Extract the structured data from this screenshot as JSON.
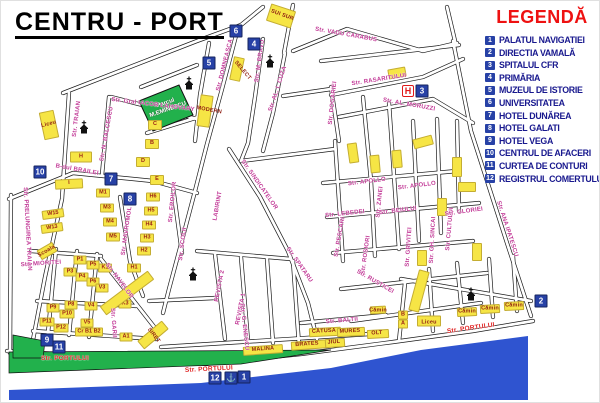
{
  "title": "CENTRU - PORT",
  "legend": {
    "title": "LEGENDĂ",
    "items": [
      {
        "num": "1",
        "label": "PALATUL NAVIGATIEI"
      },
      {
        "num": "2",
        "label": "DIRECTIA VAMALĂ"
      },
      {
        "num": "3",
        "label": "SPITALUL CFR"
      },
      {
        "num": "4",
        "label": "PRIMĂRIA"
      },
      {
        "num": "5",
        "label": "MUZEUL DE ISTORIE"
      },
      {
        "num": "6",
        "label": "UNIVERSITATEA"
      },
      {
        "num": "7",
        "label": "HOTEL DUNĂREA"
      },
      {
        "num": "8",
        "label": "HOTEL GALATI"
      },
      {
        "num": "9",
        "label": "HOTEL VEGA"
      },
      {
        "num": "10",
        "label": "CENTRUL DE AFACERI"
      },
      {
        "num": "11",
        "label": "CURTEA DE CONTURI"
      },
      {
        "num": "12",
        "label": "REGISTRUL COMERTULUI"
      }
    ]
  },
  "park": {
    "line1": "Parcul",
    "line2": "M.EMINESCU"
  },
  "colors": {
    "legend_red": "#ee1111",
    "legend_text_blue": "#18188e",
    "marker_blue": "#2741a6",
    "street_label_pink": "#c23a97",
    "portului_red": "#e02525",
    "building_yellow": "#f6e545",
    "building_text_red": "#8f1d12",
    "park_green": "#22b14c",
    "water_blue": "#2f54d0",
    "hospital_red": "#e01818"
  },
  "markers": [
    {
      "n": "1",
      "x": 243,
      "y": 376
    },
    {
      "n": "2",
      "x": 540,
      "y": 300
    },
    {
      "n": "3",
      "x": 421,
      "y": 90
    },
    {
      "n": "4",
      "x": 253,
      "y": 43
    },
    {
      "n": "5",
      "x": 208,
      "y": 62
    },
    {
      "n": "6",
      "x": 235,
      "y": 30
    },
    {
      "n": "7",
      "x": 110,
      "y": 178
    },
    {
      "n": "8",
      "x": 129,
      "y": 198
    },
    {
      "n": "9",
      "x": 46,
      "y": 339
    },
    {
      "n": "10",
      "x": 39,
      "y": 171
    },
    {
      "n": "11",
      "x": 58,
      "y": 346
    },
    {
      "n": "12",
      "x": 214,
      "y": 377
    }
  ],
  "hospital_marker": {
    "label": "H",
    "x": 407,
    "y": 90
  },
  "anchor_marker": {
    "icon": "anchor-icon",
    "glyph": "⚓",
    "x": 230,
    "y": 377
  },
  "churches": [
    {
      "icon": "church-icon",
      "x": 188,
      "y": 82
    },
    {
      "icon": "church-icon",
      "x": 269,
      "y": 60
    },
    {
      "icon": "church-icon",
      "x": 83,
      "y": 126
    },
    {
      "icon": "church-icon",
      "x": 192,
      "y": 273
    },
    {
      "icon": "church-icon",
      "x": 470,
      "y": 293
    }
  ],
  "street_labels": [
    {
      "t": "Str. TRAIAN",
      "x": 76,
      "y": 118,
      "r": -83
    },
    {
      "t": "Str. N. BALCESCU",
      "x": 106,
      "y": 133,
      "r": -80
    },
    {
      "t": "Str. Gral IACOB LAHOVARY",
      "x": 152,
      "y": 104,
      "r": 7
    },
    {
      "t": "Str. DOMNEASCA",
      "x": 224,
      "y": 64,
      "r": -76
    },
    {
      "t": "Str. M. BRAVU",
      "x": 259,
      "y": 60,
      "r": -82
    },
    {
      "t": "Str. AL. I. CUZA",
      "x": 277,
      "y": 88,
      "r": -72
    },
    {
      "t": "Str. VADU CARABUS",
      "x": 345,
      "y": 34,
      "r": 10
    },
    {
      "t": "Str. RASARITULUI",
      "x": 378,
      "y": 79,
      "r": -9
    },
    {
      "t": "Str. AL. MORUZZI",
      "x": 408,
      "y": 104,
      "r": 10
    },
    {
      "t": "Str. DOGARIEI",
      "x": 332,
      "y": 102,
      "r": -84
    },
    {
      "t": "B-dul BRAILEI",
      "x": 76,
      "y": 169,
      "r": 10
    },
    {
      "t": "Str. EROILOR",
      "x": 172,
      "y": 201,
      "r": -84
    },
    {
      "t": "Str. SINDICATELOR",
      "x": 258,
      "y": 184,
      "r": 55
    },
    {
      "t": "LABIRINT",
      "x": 217,
      "y": 205,
      "r": -80
    },
    {
      "t": "Str. MAVROMOL",
      "x": 126,
      "y": 230,
      "r": -82
    },
    {
      "t": "Str. APOLLO",
      "x": 366,
      "y": 181,
      "r": -7
    },
    {
      "t": "Str. APOLLO",
      "x": 416,
      "y": 185,
      "r": -7
    },
    {
      "t": "Str. ZANEI",
      "x": 379,
      "y": 201,
      "r": -84
    },
    {
      "t": "Str. LEBEDEI",
      "x": 344,
      "y": 213,
      "r": -6
    },
    {
      "t": "Str. BEIULUI",
      "x": 397,
      "y": 210,
      "r": -7
    },
    {
      "t": "Str. PESCARI",
      "x": 339,
      "y": 236,
      "r": -80
    },
    {
      "t": "Str. ROSIORI",
      "x": 365,
      "y": 254,
      "r": -82
    },
    {
      "t": "Str. GRIVITEI",
      "x": 408,
      "y": 246,
      "r": -86
    },
    {
      "t": "Str. GH. SINCAI",
      "x": 432,
      "y": 239,
      "r": -87
    },
    {
      "t": "Str. CULTULUI",
      "x": 449,
      "y": 228,
      "r": -85
    },
    {
      "t": "Str. GLORIEI",
      "x": 463,
      "y": 211,
      "r": -8
    },
    {
      "t": "Str. ANA IPATESCU",
      "x": 506,
      "y": 228,
      "r": 72
    },
    {
      "t": "Str. PRELUNGIREA TRAIAN",
      "x": 26,
      "y": 228,
      "r": 87
    },
    {
      "t": "Str. NAVELOR",
      "x": 118,
      "y": 280,
      "r": 53
    },
    {
      "t": "Str. SCOLII",
      "x": 182,
      "y": 243,
      "r": -83
    },
    {
      "t": "Str. MIORITEI",
      "x": 40,
      "y": 263,
      "r": -4
    },
    {
      "t": "Str. GARII",
      "x": 112,
      "y": 322,
      "r": 86
    },
    {
      "t": "Str. G. ENESCU",
      "x": 243,
      "y": 326,
      "r": 84
    },
    {
      "t": "REVISTA 2",
      "x": 219,
      "y": 285,
      "r": -79
    },
    {
      "t": "REVISTA 1",
      "x": 240,
      "y": 308,
      "r": -79
    },
    {
      "t": "Str. SPATARU",
      "x": 298,
      "y": 264,
      "r": 55
    },
    {
      "t": "Str. BALTII",
      "x": 341,
      "y": 320,
      "r": -5
    },
    {
      "t": "Str. RUSTICEI",
      "x": 374,
      "y": 281,
      "r": 30
    },
    {
      "t": "Str. PORTULUI",
      "x": 64,
      "y": 358,
      "r": 0,
      "v": "r"
    },
    {
      "t": "Str. PORTULUI",
      "x": 208,
      "y": 369,
      "r": -3,
      "v": "r"
    },
    {
      "t": "Str. PORTULUI",
      "x": 470,
      "y": 328,
      "r": -8,
      "v": "r"
    },
    {
      "t": "Liceu",
      "x": 48,
      "y": 124,
      "r": -15,
      "v": "b"
    },
    {
      "t": "SELECT",
      "x": 241,
      "y": 70,
      "r": 50,
      "v": "b"
    },
    {
      "t": "MODERN",
      "x": 208,
      "y": 110,
      "r": 10,
      "v": "b"
    },
    {
      "t": "SUI SUR",
      "x": 281,
      "y": 15,
      "r": 20,
      "v": "b"
    },
    {
      "t": "Scoala",
      "x": 46,
      "y": 251,
      "r": -30,
      "v": "b"
    },
    {
      "t": "SIRET",
      "x": 152,
      "y": 335,
      "r": 52,
      "v": "b"
    },
    {
      "t": "MALINA",
      "x": 262,
      "y": 349,
      "r": -4,
      "v": "b"
    },
    {
      "t": "BRATES",
      "x": 306,
      "y": 344,
      "r": -4,
      "v": "b"
    },
    {
      "t": "JIUL",
      "x": 333,
      "y": 342,
      "r": -4,
      "v": "b"
    },
    {
      "t": "CĂTUSA",
      "x": 323,
      "y": 331,
      "r": -3,
      "v": "b"
    },
    {
      "t": "MURES",
      "x": 349,
      "y": 331,
      "r": -3,
      "v": "b"
    },
    {
      "t": "OLT",
      "x": 376,
      "y": 333,
      "r": -3,
      "v": "b"
    },
    {
      "t": "Liceu",
      "x": 428,
      "y": 322,
      "r": 0,
      "v": "b"
    },
    {
      "t": "Cămin",
      "x": 466,
      "y": 311,
      "r": 0,
      "v": "b"
    },
    {
      "t": "Cămin",
      "x": 489,
      "y": 308,
      "r": 0,
      "v": "b"
    },
    {
      "t": "Cămin",
      "x": 513,
      "y": 305,
      "r": 0,
      "v": "b"
    },
    {
      "t": "Cămin",
      "x": 377,
      "y": 310,
      "r": 0,
      "v": "b"
    }
  ],
  "buildings": [
    {
      "l": "",
      "x": 48,
      "y": 124,
      "w": 13,
      "h": 26,
      "r": -12
    },
    {
      "l": "H",
      "x": 80,
      "y": 156,
      "w": 20,
      "h": 9,
      "r": 0
    },
    {
      "l": "I",
      "x": 68,
      "y": 183,
      "w": 26,
      "h": 8,
      "r": -3
    },
    {
      "l": "C",
      "x": 154,
      "y": 124,
      "w": 12,
      "h": 8,
      "r": 0
    },
    {
      "l": "B",
      "x": 151,
      "y": 143,
      "w": 12,
      "h": 8,
      "r": 0
    },
    {
      "l": "D",
      "x": 142,
      "y": 161,
      "w": 12,
      "h": 8,
      "r": 0
    },
    {
      "l": "E",
      "x": 156,
      "y": 179,
      "w": 12,
      "h": 8,
      "r": 0
    },
    {
      "l": "M1",
      "x": 102,
      "y": 192,
      "w": 12,
      "h": 7,
      "r": 0
    },
    {
      "l": "M3",
      "x": 106,
      "y": 207,
      "w": 12,
      "h": 7,
      "r": 0
    },
    {
      "l": "M4",
      "x": 109,
      "y": 221,
      "w": 12,
      "h": 7,
      "r": 0
    },
    {
      "l": "M5",
      "x": 112,
      "y": 236,
      "w": 12,
      "h": 7,
      "r": 0
    },
    {
      "l": "H6",
      "x": 152,
      "y": 196,
      "w": 12,
      "h": 7,
      "r": 0
    },
    {
      "l": "H5",
      "x": 150,
      "y": 210,
      "w": 12,
      "h": 7,
      "r": 0
    },
    {
      "l": "H4",
      "x": 148,
      "y": 224,
      "w": 12,
      "h": 7,
      "r": 0
    },
    {
      "l": "H3",
      "x": 146,
      "y": 237,
      "w": 12,
      "h": 7,
      "r": 0
    },
    {
      "l": "H2",
      "x": 143,
      "y": 250,
      "w": 12,
      "h": 7,
      "r": 0
    },
    {
      "l": "H1",
      "x": 133,
      "y": 267,
      "w": 12,
      "h": 7,
      "r": 0
    },
    {
      "l": "W15",
      "x": 52,
      "y": 213,
      "w": 20,
      "h": 7,
      "r": -8
    },
    {
      "l": "W13",
      "x": 51,
      "y": 227,
      "w": 20,
      "h": 7,
      "r": -8
    },
    {
      "l": "K1",
      "x": 104,
      "y": 267,
      "w": 12,
      "h": 7,
      "r": 0
    },
    {
      "l": "P1",
      "x": 79,
      "y": 259,
      "w": 11,
      "h": 7,
      "r": 0
    },
    {
      "l": "P5",
      "x": 92,
      "y": 264,
      "w": 11,
      "h": 7,
      "r": 0
    },
    {
      "l": "P3",
      "x": 69,
      "y": 271,
      "w": 11,
      "h": 7,
      "r": 0
    },
    {
      "l": "P4",
      "x": 81,
      "y": 276,
      "w": 11,
      "h": 7,
      "r": 0
    },
    {
      "l": "P6",
      "x": 92,
      "y": 281,
      "w": 11,
      "h": 7,
      "r": 0
    },
    {
      "l": "V3",
      "x": 101,
      "y": 287,
      "w": 11,
      "h": 7,
      "r": 0
    },
    {
      "l": "P9",
      "x": 52,
      "y": 307,
      "w": 11,
      "h": 7,
      "r": 0
    },
    {
      "l": "P8",
      "x": 70,
      "y": 304,
      "w": 11,
      "h": 7,
      "r": 0
    },
    {
      "l": "P10",
      "x": 66,
      "y": 313,
      "w": 13,
      "h": 7,
      "r": 0
    },
    {
      "l": "P11",
      "x": 46,
      "y": 321,
      "w": 13,
      "h": 7,
      "r": 0
    },
    {
      "l": "P12",
      "x": 60,
      "y": 327,
      "w": 13,
      "h": 7,
      "r": 0
    },
    {
      "l": "V4",
      "x": 90,
      "y": 305,
      "w": 11,
      "h": 7,
      "r": 0
    },
    {
      "l": "V5",
      "x": 86,
      "y": 322,
      "w": 11,
      "h": 7,
      "r": 0
    },
    {
      "l": "Cr B1 B2",
      "x": 88,
      "y": 331,
      "w": 26,
      "h": 7,
      "r": 0
    },
    {
      "l": "K3",
      "x": 124,
      "y": 303,
      "w": 11,
      "h": 7,
      "r": 0
    },
    {
      "l": "A1",
      "x": 125,
      "y": 336,
      "w": 11,
      "h": 7,
      "r": 0
    },
    {
      "l": "",
      "x": 236,
      "y": 68,
      "w": 9,
      "h": 22,
      "r": 12
    },
    {
      "l": "",
      "x": 204,
      "y": 110,
      "w": 11,
      "h": 30,
      "r": 8
    },
    {
      "l": "",
      "x": 280,
      "y": 15,
      "w": 24,
      "h": 16,
      "r": 18
    },
    {
      "l": "",
      "x": 46,
      "y": 250,
      "w": 16,
      "h": 9,
      "r": -30
    },
    {
      "l": "B",
      "x": 402,
      "y": 314,
      "w": 8,
      "h": 7,
      "r": 0
    },
    {
      "l": "A",
      "x": 402,
      "y": 323,
      "w": 8,
      "h": 7,
      "r": 0
    },
    {
      "l": "",
      "x": 428,
      "y": 320,
      "w": 22,
      "h": 9,
      "r": 0
    },
    {
      "l": "",
      "x": 466,
      "y": 311,
      "w": 18,
      "h": 7,
      "r": -3
    },
    {
      "l": "",
      "x": 489,
      "y": 308,
      "w": 18,
      "h": 7,
      "r": -3
    },
    {
      "l": "",
      "x": 513,
      "y": 305,
      "w": 18,
      "h": 7,
      "r": -3
    },
    {
      "l": "",
      "x": 377,
      "y": 309,
      "w": 14,
      "h": 6,
      "r": -3
    },
    {
      "l": "",
      "x": 126,
      "y": 292,
      "w": 9,
      "h": 58,
      "r": 53
    },
    {
      "l": "",
      "x": 152,
      "y": 334,
      "w": 9,
      "h": 30,
      "r": 50
    },
    {
      "l": "",
      "x": 418,
      "y": 290,
      "w": 9,
      "h": 40,
      "r": 15
    },
    {
      "l": "",
      "x": 262,
      "y": 349,
      "w": 38,
      "h": 7,
      "r": -4
    },
    {
      "l": "",
      "x": 308,
      "y": 344,
      "w": 34,
      "h": 7,
      "r": -4
    },
    {
      "l": "",
      "x": 334,
      "y": 342,
      "w": 18,
      "h": 7,
      "r": -4
    },
    {
      "l": "",
      "x": 324,
      "y": 331,
      "w": 30,
      "h": 7,
      "r": -3
    },
    {
      "l": "",
      "x": 350,
      "y": 331,
      "w": 26,
      "h": 7,
      "r": -3
    },
    {
      "l": "",
      "x": 377,
      "y": 333,
      "w": 20,
      "h": 7,
      "r": -3
    },
    {
      "l": "",
      "x": 352,
      "y": 152,
      "w": 8,
      "h": 18,
      "r": -8
    },
    {
      "l": "",
      "x": 374,
      "y": 163,
      "w": 8,
      "h": 16,
      "r": -5
    },
    {
      "l": "",
      "x": 396,
      "y": 158,
      "w": 8,
      "h": 16,
      "r": -5
    },
    {
      "l": "",
      "x": 422,
      "y": 141,
      "w": 18,
      "h": 8,
      "r": -15
    },
    {
      "l": "",
      "x": 456,
      "y": 166,
      "w": 8,
      "h": 18,
      "r": 0
    },
    {
      "l": "",
      "x": 466,
      "y": 186,
      "w": 16,
      "h": 8,
      "r": 0
    },
    {
      "l": "",
      "x": 441,
      "y": 206,
      "w": 8,
      "h": 16,
      "r": 0
    },
    {
      "l": "",
      "x": 476,
      "y": 251,
      "w": 8,
      "h": 16,
      "r": 0
    },
    {
      "l": "",
      "x": 421,
      "y": 257,
      "w": 8,
      "h": 14,
      "r": 0
    },
    {
      "l": "",
      "x": 396,
      "y": 72,
      "w": 16,
      "h": 8,
      "r": -10
    }
  ]
}
